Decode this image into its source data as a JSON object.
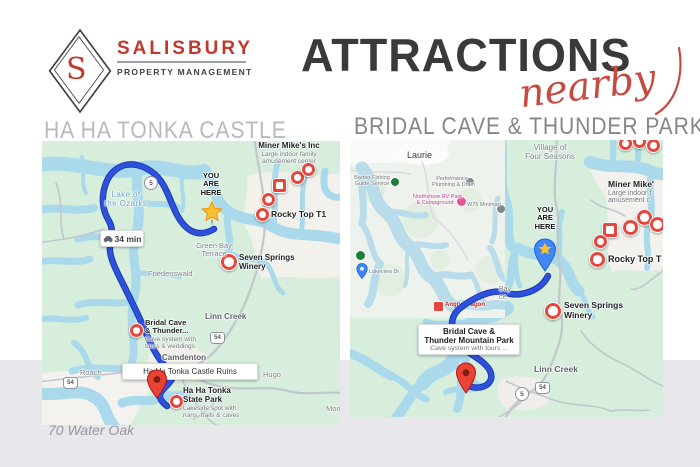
{
  "brand": {
    "initial": "S",
    "name": "SALISBURY",
    "tagline": "PROPERTY MANAGEMENT"
  },
  "title": {
    "main": "ATTRACTIONS",
    "accent": "nearby"
  },
  "footer": {
    "address": "70 Water Oak"
  },
  "left": {
    "heading": "HA HA TONKA CASTLE",
    "you_are_here": {
      "l1": "YOU",
      "l2": "ARE",
      "l3": "HERE"
    },
    "drive_time": "34 min",
    "lake_label": {
      "l1": "Lake of",
      "l2": "the Ozarks"
    },
    "miner": {
      "title": "Miner Mike's Inc",
      "sub1": "Large indoor family",
      "sub2": "amusement center"
    },
    "rocky": "Rocky Top T1",
    "winery": {
      "l1": "Seven Springs",
      "l2": "Winery"
    },
    "bridal": {
      "l1": "Bridal Cave",
      "l2": "& Thunder...",
      "s1": "Cave system with",
      "s2": "tours & weddings"
    },
    "ruins_box": "Ha Ha Tonka Castle Ruins",
    "state_park": {
      "l1": "Ha Ha Tonka",
      "l2": "State Park",
      "s1": "Lakeside spot with",
      "s2": "ruins, trails & caves"
    },
    "towns": {
      "green_bay1": "Green Bay",
      "green_bay2": "Terrace",
      "friedenswald": "Friedenswald",
      "linn_creek": "Linn Creek",
      "camdenton": "Camdenton",
      "roach": "Roach",
      "hugo": "Hugo",
      "mont": "Mont"
    },
    "badges": {
      "b5": "5",
      "b54": "54",
      "b54b": "54"
    }
  },
  "right": {
    "heading": "BRIDAL CAVE & THUNDER PARK",
    "you_are_here": {
      "l1": "YOU",
      "l2": "ARE",
      "l3": "HERE"
    },
    "village": {
      "l1": "Village of",
      "l2": "Four Seasons"
    },
    "miner": {
      "title": "Miner Mike'",
      "sub1": "Large indoor f",
      "sub2": "amusement c"
    },
    "rocky": "Rocky Top T",
    "winery": {
      "l1": "Seven Springs",
      "l2": "Winery"
    },
    "bridal_box": {
      "l1": "Bridal Cave &",
      "l2": "Thunder Mountain Park",
      "s1": "Cave system with tours ..."
    },
    "bay": {
      "l1": "Bay",
      "l2": "ce"
    },
    "towns": {
      "linn_creek": "Linn Creek"
    },
    "badges": {
      "b5": "5",
      "b54": "54"
    },
    "inset": {
      "laurie": "Laurie",
      "barber": {
        "l1": "Barber Fishing",
        "l2": "Guide Service"
      },
      "plumbing": {
        "l1": "Performance",
        "l2": "Plumbing & Drain"
      },
      "rv": {
        "l1": "Northshore RV Park",
        "l2": "& Campground"
      },
      "minimart": "W75 Minimart",
      "street_pin": "Lakeview Dr",
      "dragon": "Angry Dragon"
    }
  },
  "colors": {
    "brand_red": "#c0392f",
    "title_dark": "#3a3a3c",
    "accent_red": "#c74a41",
    "route_blue": "#2e51dd",
    "pin_red": "#e8453c",
    "water": "#a9d9eb",
    "land": "#d7eedd",
    "band_gray": "#e8e8ec",
    "header_gray_left": "#b6babd",
    "header_gray_right": "#83878c"
  }
}
